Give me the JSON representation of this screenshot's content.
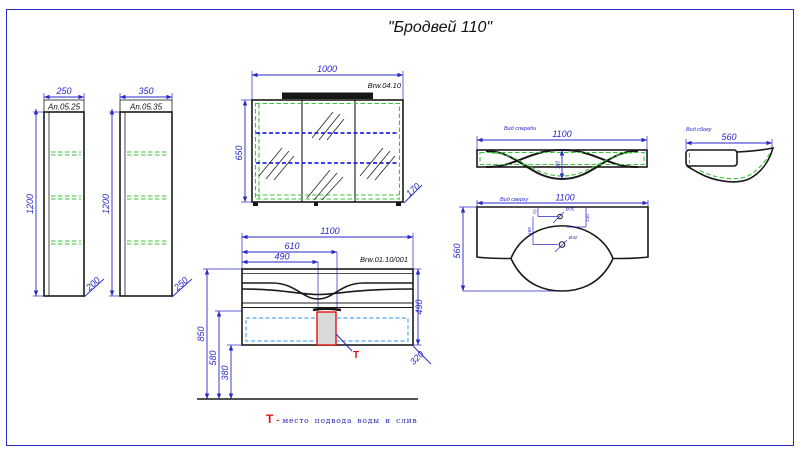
{
  "title": "\"Бродвей 110\"",
  "cab1": {
    "width": "250",
    "code": "An.05.25",
    "height": "1200",
    "depth": "200"
  },
  "cab2": {
    "width": "350",
    "code": "An.05.35",
    "height": "1200",
    "depth": "250"
  },
  "mirror": {
    "width": "1000",
    "code": "Brw.04.10",
    "height": "650",
    "depth": "170"
  },
  "vanity": {
    "width": "1100",
    "code": "Brw.01.10/001",
    "w610": "610",
    "w490": "490",
    "height": "490",
    "depth": "320",
    "h850": "850",
    "h580": "580",
    "h380": "380",
    "t": "Т"
  },
  "basin_front": {
    "label": "Вид спереди",
    "width": "1100",
    "bowl_depth": "180"
  },
  "basin_side": {
    "label": "Вид сбоку",
    "width": "560"
  },
  "basin_top": {
    "label": "Вид сверху",
    "width": "1100",
    "depth": "560",
    "hole1": "Ø35",
    "hole2": "Ø42",
    "d70": "70",
    "d130": "130",
    "d185": "185"
  },
  "legend": {
    "t": "Т",
    "sep": "-",
    "text": "место подвода воды и слив"
  }
}
